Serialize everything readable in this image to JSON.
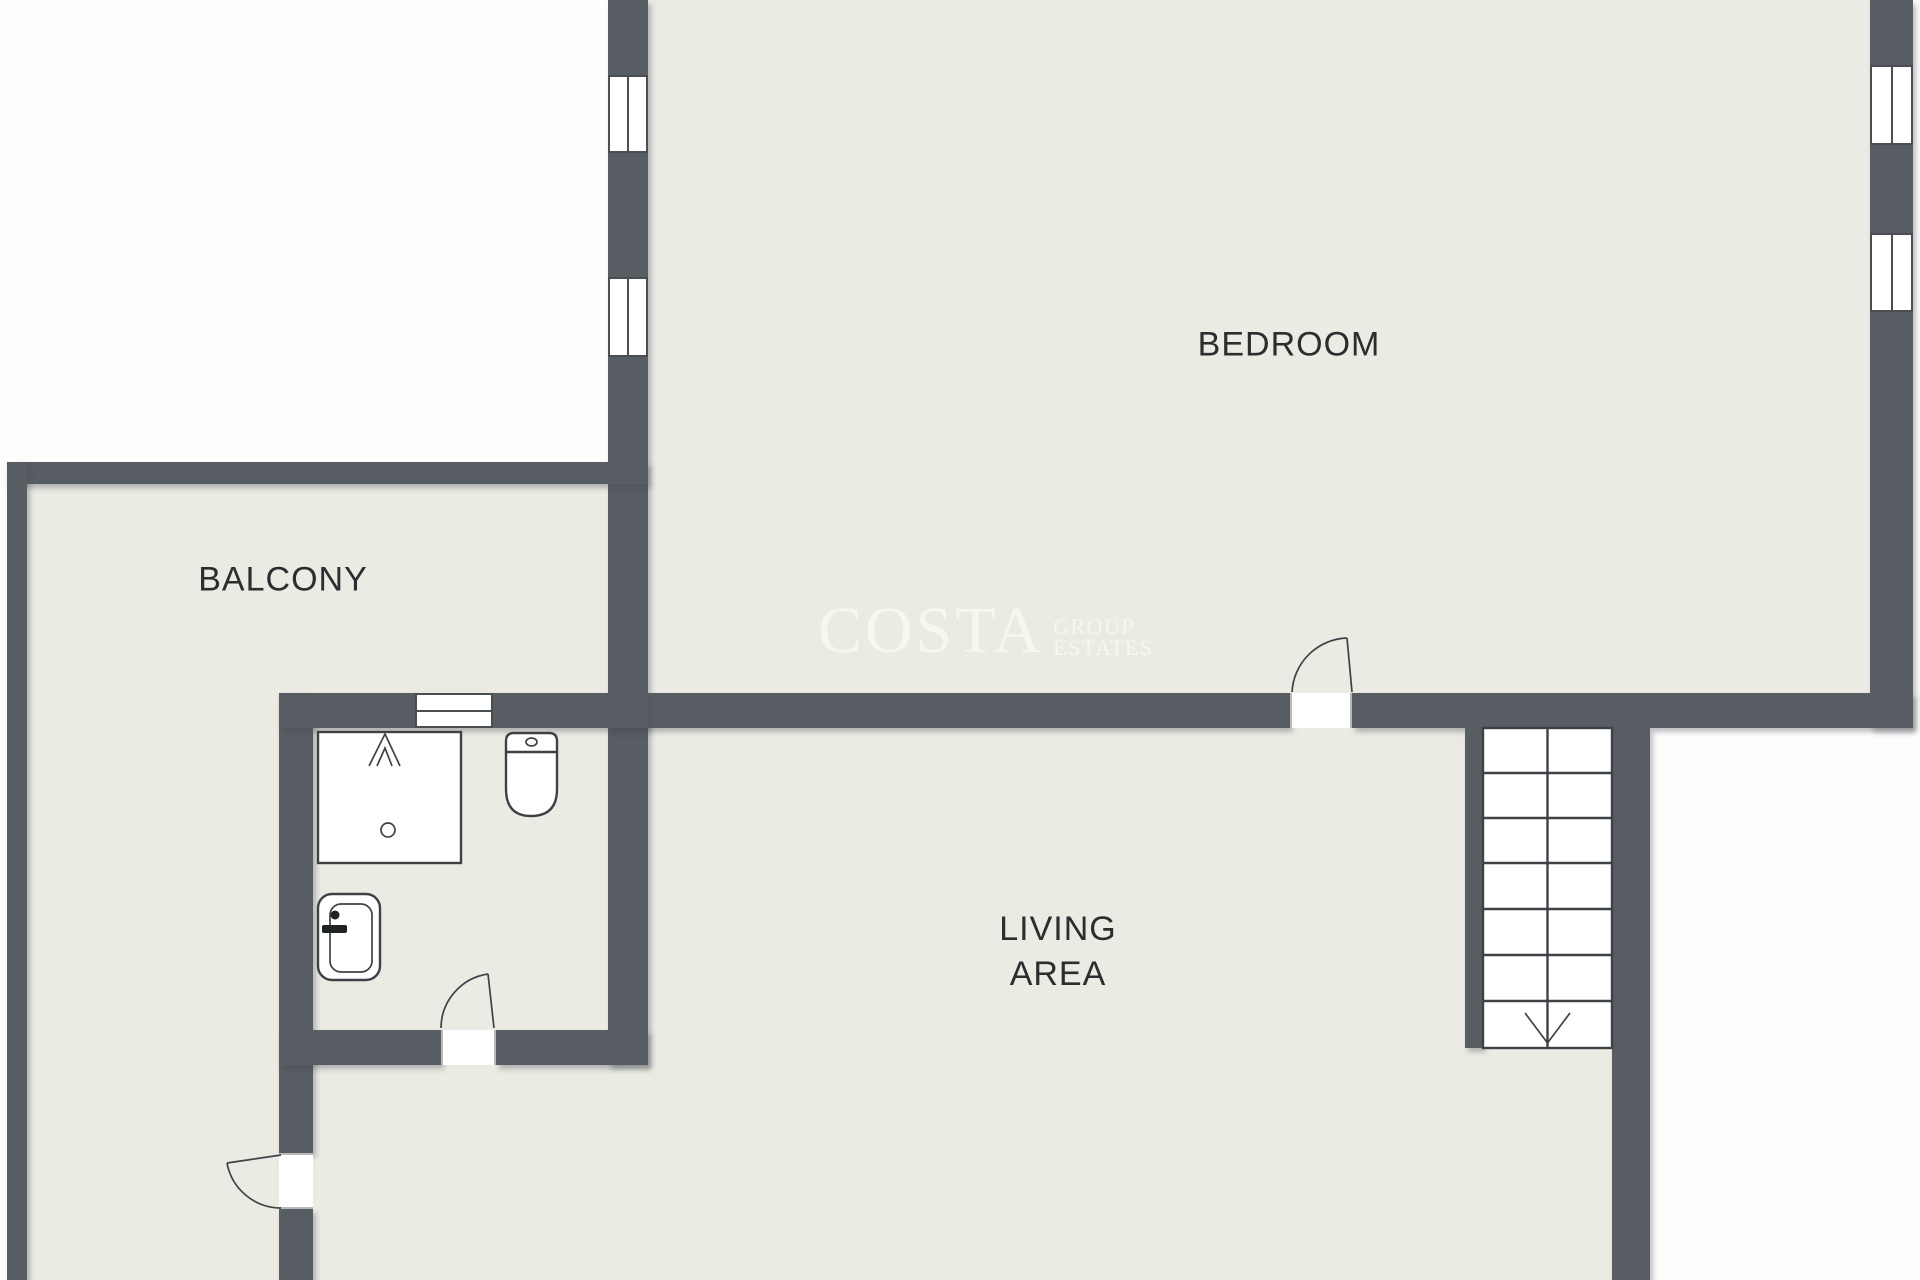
{
  "floorplan": {
    "rooms": {
      "bedroom": {
        "label": "BEDROOM"
      },
      "balcony": {
        "label": "BALCONY"
      },
      "living": {
        "line1": "LIVING",
        "line2": "AREA"
      }
    },
    "fixtures": [
      "shower",
      "toilet",
      "sink",
      "staircase"
    ],
    "stairs": {
      "direction": "down",
      "treads": 7
    },
    "doors": [
      "bedroom-door",
      "bathroom-door",
      "balcony-door"
    ],
    "windows_count": 5
  },
  "watermark": {
    "name": "COSTA",
    "line1": "GROUP",
    "line2": "ESTATES"
  },
  "colors": {
    "wall": "#585d63",
    "floor": "#ebebe4",
    "outside": "#fdfdfc",
    "line": "#3e4246",
    "label_text": "#2b2d2e",
    "watermark": "#fafaf3"
  }
}
